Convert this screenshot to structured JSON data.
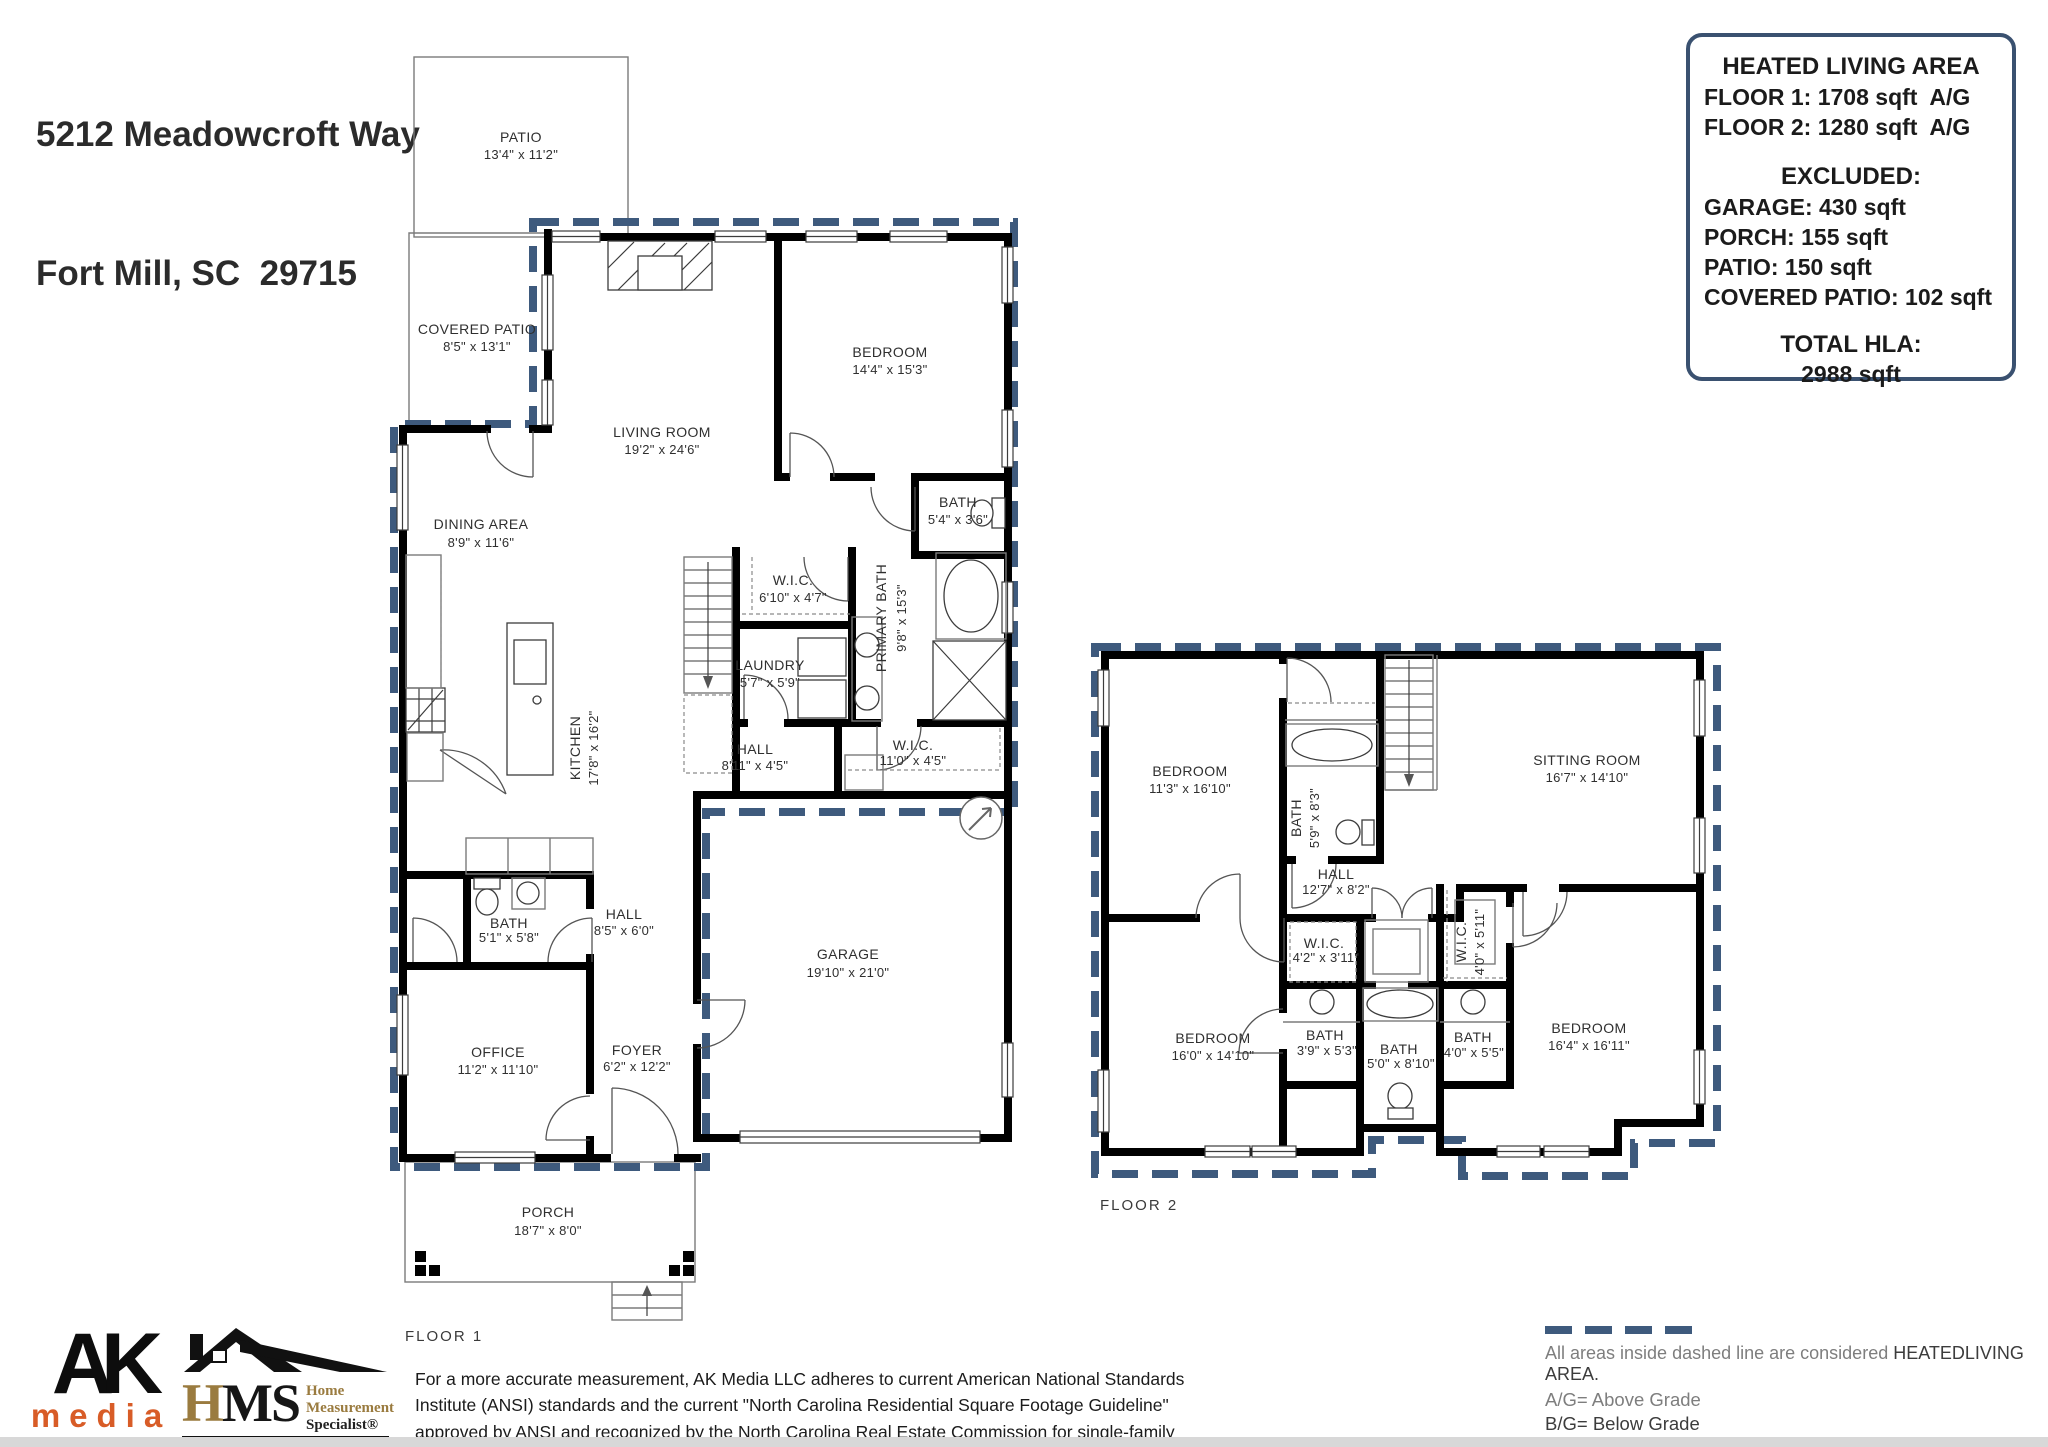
{
  "title": {
    "line1": "5212 Meadowcroft Way",
    "line2": "Fort Mill, SC  29715"
  },
  "summary": {
    "heading": "HEATED LIVING AREA",
    "floor1": "FLOOR 1: 1708 sqft  A/G",
    "floor2": "FLOOR 2: 1280 sqft  A/G",
    "excluded_heading": "EXCLUDED:",
    "excluded": [
      "GARAGE: 430 sqft",
      "PORCH: 155 sqft",
      "PATIO: 150 sqft",
      "COVERED PATIO: 102 sqft"
    ],
    "total_heading": "TOTAL HLA:",
    "total": "2988 sqft"
  },
  "floor1": {
    "label": "FLOOR 1",
    "patio": {
      "name": "PATIO",
      "dims": "13'4\" x 11'2\""
    },
    "covered_patio": {
      "name": "COVERED PATIO",
      "dims": "8'5\" x 13'1\""
    },
    "living": {
      "name": "LIVING ROOM",
      "dims": "19'2\" x 24'6\""
    },
    "bedroom": {
      "name": "BEDROOM",
      "dims": "14'4\" x 15'3\""
    },
    "bath1": {
      "name": "BATH",
      "dims": "5'4\" x 3'6\""
    },
    "dining": {
      "name": "DINING AREA",
      "dims": "8'9\" x 11'6\""
    },
    "wic1": {
      "name": "W.I.C.",
      "dims": "6'10\" x 4'7\""
    },
    "laundry": {
      "name": "LAUNDRY",
      "dims": "5'7\" x 5'9\""
    },
    "primary_bath": {
      "name": "PRIMARY BATH",
      "dims": "9'8\" x 15'3\""
    },
    "kitchen": {
      "name": "KITCHEN",
      "dims": "17'8\" x 16'2\""
    },
    "hall1": {
      "name": "HALL",
      "dims": "8'11\" x 4'5\""
    },
    "wic2": {
      "name": "W.I.C.",
      "dims": "11'0\" x 4'5\""
    },
    "hall2": {
      "name": "HALL",
      "dims": "8'5\" x 6'0\""
    },
    "bath2": {
      "name": "BATH",
      "dims": "5'1\" x 5'8\""
    },
    "office": {
      "name": "OFFICE",
      "dims": "11'2\" x 11'10\""
    },
    "foyer": {
      "name": "FOYER",
      "dims": "6'2\" x 12'2\""
    },
    "garage": {
      "name": "GARAGE",
      "dims": "19'10\" x 21'0\""
    },
    "porch": {
      "name": "PORCH",
      "dims": "18'7\" x 8'0\""
    }
  },
  "floor2": {
    "label": "FLOOR 2",
    "bedroom1": {
      "name": "BEDROOM",
      "dims": "11'3\" x 16'10\""
    },
    "bath1": {
      "name": "BATH",
      "dims": "5'9\" x 8'3\""
    },
    "sitting": {
      "name": "SITTING ROOM",
      "dims": "16'7\" x 14'10\""
    },
    "hall": {
      "name": "HALL",
      "dims": "12'7\" x 8'2\""
    },
    "wic1": {
      "name": "W.I.C.",
      "dims": "4'2\" x 3'11\""
    },
    "wic2": {
      "name": "W.I.C.",
      "dims": "4'0\" x 5'11\""
    },
    "bedroom2": {
      "name": "BEDROOM",
      "dims": "16'0\" x 14'10\""
    },
    "bath2": {
      "name": "BATH",
      "dims": "3'9\" x 5'3\""
    },
    "bath3": {
      "name": "BATH",
      "dims": "5'0\" x 8'10\""
    },
    "bath4": {
      "name": "BATH",
      "dims": "4'0\" x 5'5\""
    },
    "bedroom3": {
      "name": "BEDROOM",
      "dims": "16'4\" x 16'11\""
    }
  },
  "footer": {
    "ak": {
      "top": "AK",
      "bottom": "media"
    },
    "hms": {
      "h": "H",
      "ms": "MS",
      "tag1": "Home",
      "tag2": "Measurement",
      "tag3": "Specialist®"
    },
    "disclaimer": "For a more accurate measurement, AK Media LLC adheres to current American National Standards Institute (ANSI) standards and the current \"North Carolina Residential Square Footage Guideline\" approved by ANSI and recognized by the North Carolina Real Estate Commission for single-family dwellings and townhouses for both North and South Carolina.",
    "legend": {
      "line1a": "All areas inside dashed line are considered ",
      "line1b": "HEATEDLIVING AREA.",
      "line2": "A/G= Above Grade",
      "line3": "B/G= Below Grade",
      "line4": "FINAL HLA IS ROUNDED TO NEAREST FOOT"
    }
  },
  "colors": {
    "dashed_boundary": "#3E5A7D",
    "summary_box_border": "#3A5170",
    "walls": "#000000",
    "ak_orange": "#D85C27",
    "hms_gold": "#9A7B3F"
  }
}
